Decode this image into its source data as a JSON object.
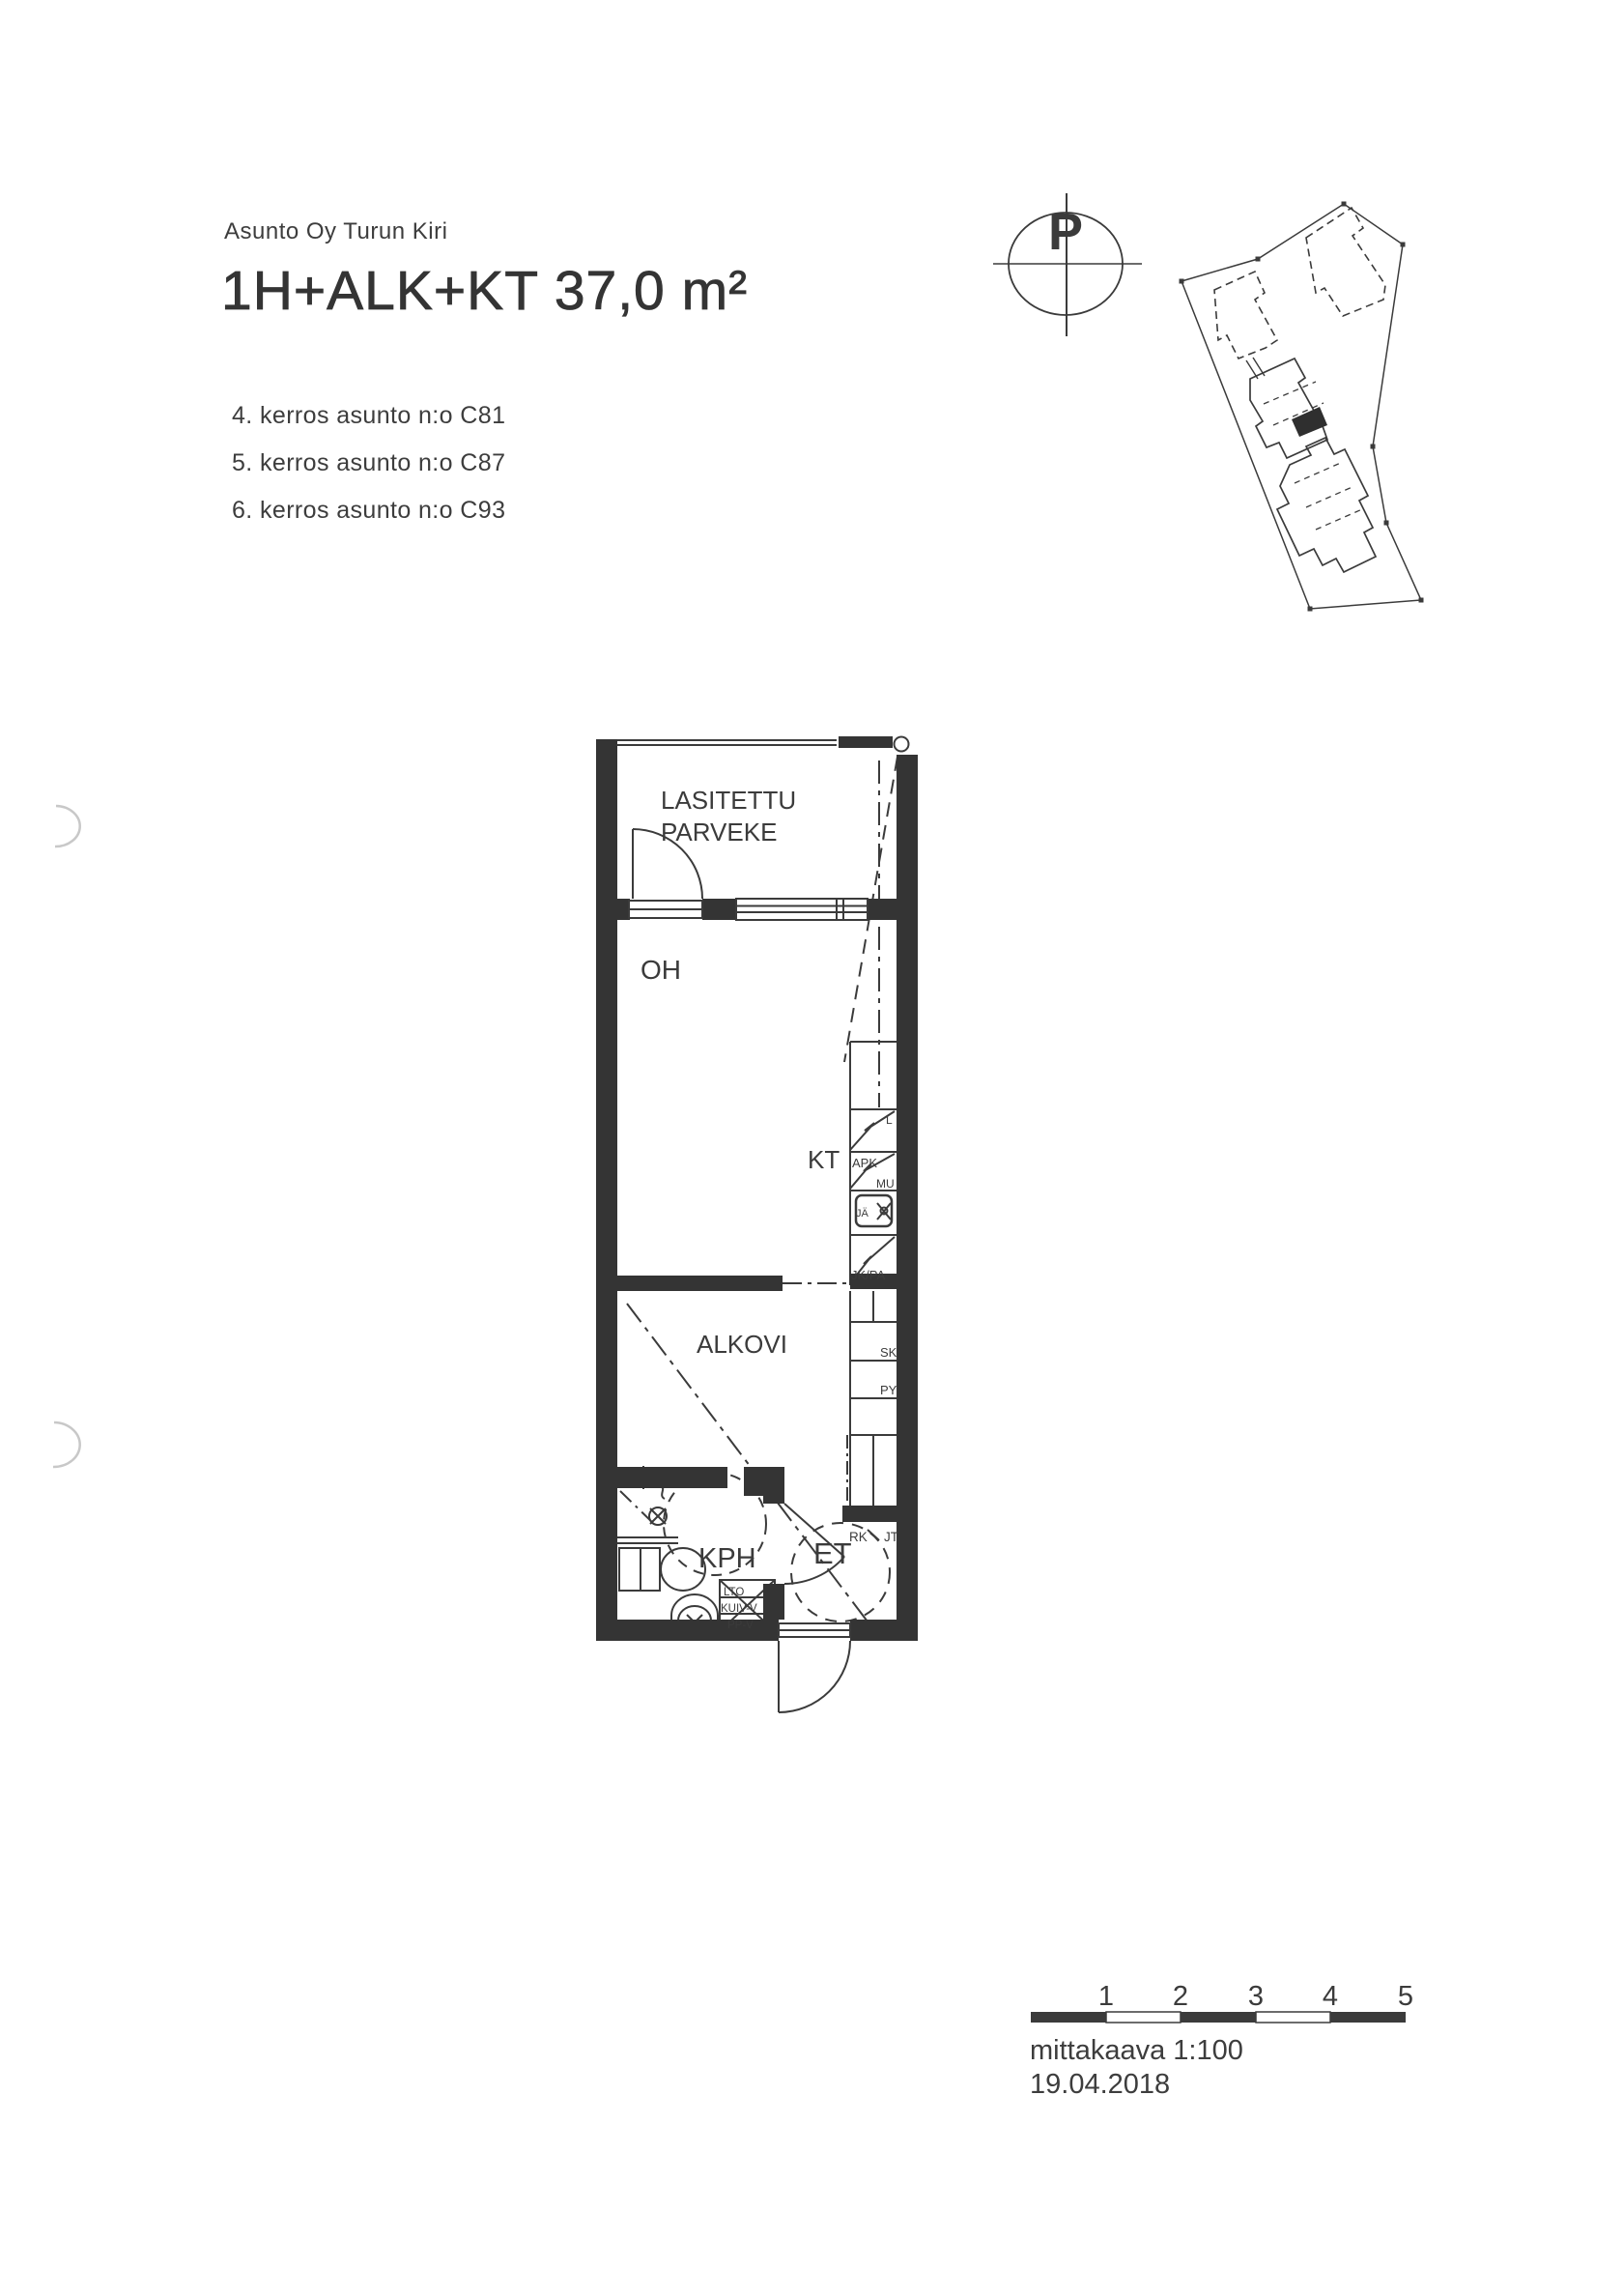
{
  "header": {
    "company": "Asunto Oy Turun Kiri",
    "title": "1H+ALK+KT 37,0 m²",
    "apartments": [
      "4. kerros asunto n:o C81",
      "5. kerros asunto n:o C87",
      "6. kerros asunto n:o C93"
    ]
  },
  "compass": {
    "north_letter": "P"
  },
  "floorplan": {
    "rooms": {
      "balcony_line1": "LASITETTU",
      "balcony_line2": "PARVEKE",
      "living": "OH",
      "kitchen": "KT",
      "alcove": "ALKOVI",
      "bathroom": "KPH",
      "hall": "ET"
    },
    "labels": {
      "stove": "L",
      "dishwasher": "APK",
      "microwave": "MU",
      "sink": "JÄ",
      "fridge_freezer": "JK/PA",
      "cleaning_closet": "SK",
      "laundry": "PY",
      "rk": "RK",
      "jt": "JT",
      "lto": "LTO",
      "dryer_reserve": "KUIV-V",
      "washer_reserve": "PP-V"
    }
  },
  "scalebar": {
    "ticks": [
      "1",
      "2",
      "3",
      "4",
      "5"
    ],
    "scale_text": "mittakaava 1:100",
    "date": "19.04.2018"
  },
  "colors": {
    "ink": "#3b3b3b",
    "wall": "#343434",
    "paper": "#ffffff",
    "artifact": "#c8c8c8"
  }
}
